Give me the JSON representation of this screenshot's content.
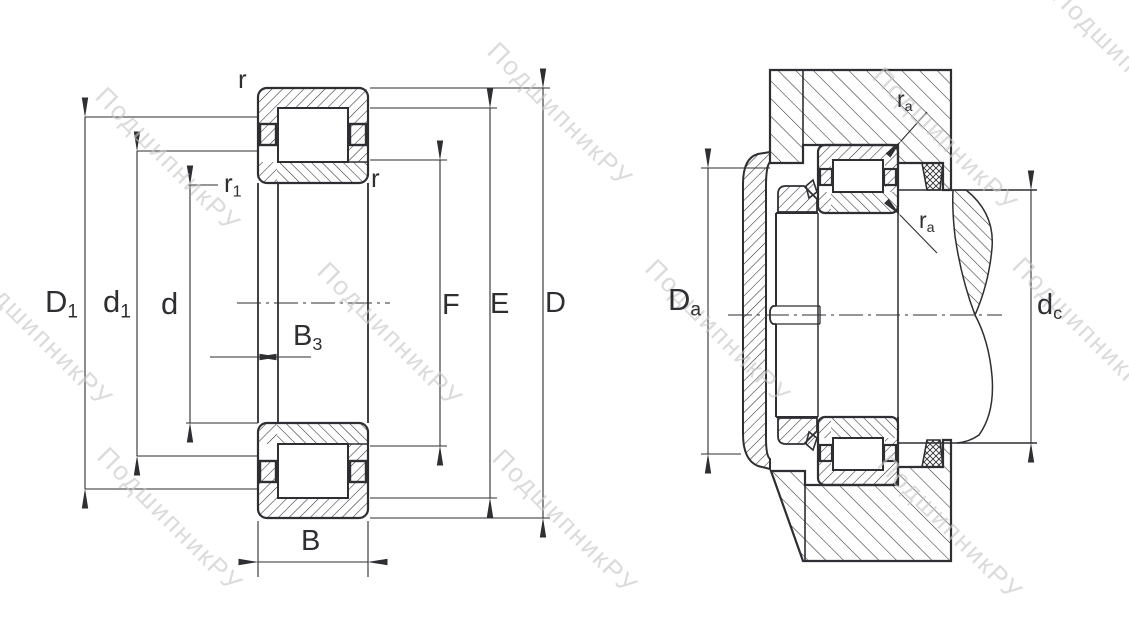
{
  "page": {
    "background": "#ffffff",
    "line_color": "#2e2e33",
    "watermark_color": "#c6c6c6",
    "description": "Cylindrical roller bearing NUP-type: cross-section with dimensions (left) and mounting/abutment dimensions (right)"
  },
  "watermark": {
    "text": "ПодшипникРУ"
  },
  "left_view": {
    "name": "bearing-cross-section-dimensions",
    "labels": {
      "r_outer": {
        "main": "r",
        "sub": ""
      },
      "r1": {
        "main": "r",
        "sub": "1"
      },
      "r_inner": {
        "main": "r",
        "sub": ""
      },
      "D1": {
        "main": "D",
        "sub": "1"
      },
      "d1": {
        "main": "d",
        "sub": "1"
      },
      "d": {
        "main": "d",
        "sub": ""
      },
      "B3": {
        "main": "B",
        "sub": "3"
      },
      "F": {
        "main": "F",
        "sub": ""
      },
      "E": {
        "main": "E",
        "sub": ""
      },
      "D": {
        "main": "D",
        "sub": ""
      },
      "B": {
        "main": "B",
        "sub": ""
      }
    }
  },
  "right_view": {
    "name": "bearing-mounting-abutment-dimensions",
    "labels": {
      "ra_top": {
        "main": "r",
        "sub": "a"
      },
      "ra_bottom": {
        "main": "r",
        "sub": "a"
      },
      "Da": {
        "main": "D",
        "sub": "a"
      },
      "dc": {
        "main": "d",
        "sub": "c"
      }
    }
  }
}
